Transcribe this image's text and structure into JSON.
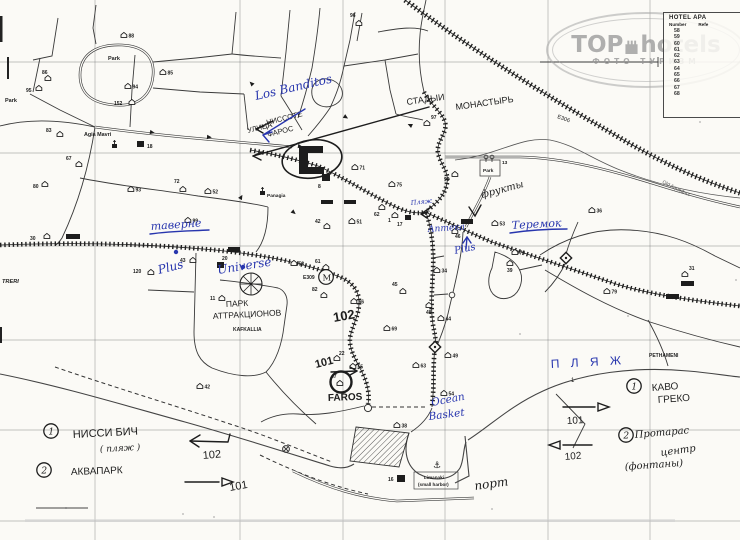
{
  "colors": {
    "paper": "#fbfaf6",
    "ink": "#1d1d1d",
    "print": "#3a3a3a",
    "blue": "#2836ae",
    "grid": "#6f6f6f",
    "gray_label": "#555555",
    "watermark": "#9a9a9a"
  },
  "watermark": {
    "brand_left": "TOP",
    "brand_right": "hotels",
    "subtitle": "ФОТО ТУРИЗМ"
  },
  "hotel_table": {
    "title": "HOTEL APA",
    "col_number": "Number",
    "col_ref": "Refe",
    "numbers": [
      "58",
      "59",
      "60",
      "61",
      "62",
      "63",
      "64",
      "65",
      "66",
      "67",
      "68"
    ]
  },
  "map": {
    "grid": {
      "vx": [
        95,
        240,
        343,
        445,
        548,
        650
      ],
      "hy": [
        62,
        153,
        246,
        340,
        430,
        521
      ]
    },
    "printed_labels": [
      {
        "t": "Park",
        "x": 108,
        "y": 60,
        "s": 5.5,
        "b": 1
      },
      {
        "t": "Park",
        "x": 5,
        "y": 102,
        "s": 5.5,
        "b": 1
      },
      {
        "t": "Park",
        "x": 483,
        "y": 172,
        "s": 4.8,
        "b": 1
      },
      {
        "t": "13",
        "x": 502,
        "y": 164,
        "s": 4.8,
        "b": 1
      },
      {
        "t": "Agia Mavri",
        "x": 84,
        "y": 136,
        "s": 5.4,
        "b": 1
      },
      {
        "t": "Panagia",
        "x": 267,
        "y": 197,
        "s": 4.8,
        "b": 1
      },
      {
        "t": "E306",
        "x": 557,
        "y": 118,
        "s": 5.6,
        "r": 20
      },
      {
        "t": "E309",
        "x": 303,
        "y": 279,
        "s": 5,
        "b": 1
      },
      {
        "t": "KAFKALLIA",
        "x": 233,
        "y": 331,
        "s": 5,
        "b": 1
      },
      {
        "t": "PETHAMENI",
        "x": 649,
        "y": 357,
        "s": 5,
        "b": 1
      },
      {
        "t": "Limanaki",
        "x": 424,
        "y": 479,
        "s": 4.6,
        "b": 1
      },
      {
        "t": "(small harbor)",
        "x": 418,
        "y": 486,
        "s": 4.6,
        "b": 1
      },
      {
        "t": "TRERI",
        "x": 2,
        "y": 283,
        "s": 5.6,
        "i": 1,
        "b": 1
      },
      {
        "t": "Old Aqueduct",
        "x": 662,
        "y": 183,
        "s": 5,
        "r": 26
      }
    ],
    "hotel_markers": [
      {
        "n": "96",
        "x": 356,
        "y": 21,
        "lx": 350,
        "ly": 17
      },
      {
        "n": "88",
        "x": 121,
        "y": 33
      },
      {
        "n": "85",
        "x": 160,
        "y": 70
      },
      {
        "n": "94",
        "x": 125,
        "y": 84
      },
      {
        "n": "86",
        "x": 45,
        "y": 76,
        "lx": 42,
        "ly": 74
      },
      {
        "n": "95",
        "x": 36,
        "y": 86,
        "lx": 26,
        "ly": 92
      },
      {
        "n": "152",
        "x": 129,
        "y": 100,
        "lx": 114,
        "ly": 105
      },
      {
        "n": "83",
        "x": 57,
        "y": 132,
        "lx": 46,
        "ly": 132
      },
      {
        "n": "67",
        "x": 76,
        "y": 162,
        "lx": 66,
        "ly": 160
      },
      {
        "n": "80",
        "x": 42,
        "y": 182,
        "lx": 33,
        "ly": 188
      },
      {
        "n": "93",
        "x": 128,
        "y": 187
      },
      {
        "n": "72",
        "x": 180,
        "y": 187,
        "lx": 174,
        "ly": 183
      },
      {
        "n": "52",
        "x": 205,
        "y": 189
      },
      {
        "n": "97",
        "x": 424,
        "y": 121,
        "lx": 431,
        "ly": 119
      },
      {
        "n": "71",
        "x": 352,
        "y": 165
      },
      {
        "n": "75",
        "x": 389,
        "y": 182
      },
      {
        "n": "62",
        "x": 379,
        "y": 205,
        "lx": 374,
        "ly": 216
      },
      {
        "n": "42",
        "x": 324,
        "y": 224,
        "lx": 315,
        "ly": 223
      },
      {
        "n": "51",
        "x": 349,
        "y": 219
      },
      {
        "n": "1",
        "x": 392,
        "y": 213,
        "lx": 388,
        "ly": 222
      },
      {
        "n": "90",
        "x": 452,
        "y": 172,
        "lx": 444,
        "ly": 181
      },
      {
        "n": "36",
        "x": 589,
        "y": 208
      },
      {
        "n": "53",
        "x": 492,
        "y": 221
      },
      {
        "n": "70",
        "x": 512,
        "y": 250
      },
      {
        "n": "39",
        "x": 507,
        "y": 261,
        "lx": 507,
        "ly": 272
      },
      {
        "n": "34",
        "x": 434,
        "y": 268
      },
      {
        "n": "46",
        "x": 452,
        "y": 229,
        "lx": 455,
        "ly": 238
      },
      {
        "n": "99",
        "x": 185,
        "y": 218
      },
      {
        "n": "43",
        "x": 190,
        "y": 258,
        "lx": 180,
        "ly": 262
      },
      {
        "n": "120",
        "x": 148,
        "y": 270,
        "lx": 133,
        "ly": 273
      },
      {
        "n": "58",
        "x": 291,
        "y": 261
      },
      {
        "n": "11",
        "x": 219,
        "y": 296,
        "lx": 210,
        "ly": 300
      },
      {
        "n": "61",
        "x": 323,
        "y": 265,
        "lx": 315,
        "ly": 263
      },
      {
        "n": "82",
        "x": 321,
        "y": 293,
        "lx": 312,
        "ly": 291
      },
      {
        "n": "66",
        "x": 351,
        "y": 299
      },
      {
        "n": "45",
        "x": 400,
        "y": 289,
        "lx": 392,
        "ly": 286
      },
      {
        "n": "48",
        "x": 426,
        "y": 303,
        "lx": 426,
        "ly": 314
      },
      {
        "n": "44",
        "x": 438,
        "y": 316
      },
      {
        "n": "69",
        "x": 384,
        "y": 326
      },
      {
        "n": "49",
        "x": 445,
        "y": 353
      },
      {
        "n": "63",
        "x": 413,
        "y": 363
      },
      {
        "n": "22",
        "x": 334,
        "y": 356,
        "lx": 339,
        "ly": 355
      },
      {
        "n": "55",
        "x": 350,
        "y": 364
      },
      {
        "n": "54",
        "x": 441,
        "y": 391
      },
      {
        "n": "38",
        "x": 394,
        "y": 423
      },
      {
        "n": "31",
        "x": 682,
        "y": 272,
        "lx": 689,
        "ly": 270
      },
      {
        "n": "79",
        "x": 604,
        "y": 289
      },
      {
        "n": "30",
        "x": 44,
        "y": 234,
        "lx": 30,
        "ly": 240
      },
      {
        "n": "42",
        "x": 197,
        "y": 384
      },
      {
        "n": "47",
        "x": 337,
        "y": 381,
        "lx": 331,
        "ly": 378
      }
    ],
    "black_squares": [
      {
        "x": 137,
        "y": 141,
        "w": 7,
        "h": 6,
        "n": "18",
        "lx": 147,
        "ly": 148
      },
      {
        "x": 322,
        "y": 174,
        "w": 8,
        "h": 7,
        "n": "8",
        "lx": 318,
        "ly": 188
      },
      {
        "x": 217,
        "y": 262,
        "w": 7,
        "h": 6,
        "n": "20",
        "lx": 222,
        "ly": 260
      },
      {
        "x": 397,
        "y": 475,
        "w": 8,
        "h": 7,
        "n": "16",
        "lx": 388,
        "ly": 481
      },
      {
        "x": 405,
        "y": 215,
        "w": 6,
        "h": 5,
        "n": "17",
        "lx": 397,
        "ly": 226
      },
      {
        "x": 461,
        "y": 219,
        "w": 12,
        "h": 5
      },
      {
        "x": 228,
        "y": 247,
        "w": 12,
        "h": 5
      },
      {
        "x": 66,
        "y": 234,
        "w": 14,
        "h": 5
      },
      {
        "x": 681,
        "y": 281,
        "w": 13,
        "h": 5
      },
      {
        "x": 666,
        "y": 294,
        "w": 13,
        "h": 5
      },
      {
        "x": 321,
        "y": 200,
        "w": 12,
        "h": 4
      },
      {
        "x": 344,
        "y": 200,
        "w": 12,
        "h": 4
      }
    ],
    "churches": [
      [
        112,
        144
      ],
      [
        260,
        191
      ]
    ],
    "trees": [
      [
        486,
        159
      ],
      [
        492,
        159
      ]
    ],
    "road_arrows": [
      [
        150,
        132,
        10
      ],
      [
        207,
        137,
        5
      ],
      [
        253,
        85,
        225
      ],
      [
        344,
        116,
        32
      ],
      [
        240,
        199,
        300
      ],
      [
        292,
        211,
        40
      ],
      [
        298,
        146,
        10
      ],
      [
        412,
        126,
        205
      ]
    ],
    "annotations": [
      {
        "t": "УЛИЦА",
        "x": 248,
        "y": 133,
        "s": 7.5,
        "r": -14,
        "c": "k",
        "f": "print"
      },
      {
        "t": "НИССОТЕ",
        "x": 267,
        "y": 125,
        "s": 7.5,
        "r": -14,
        "c": "k",
        "f": "print"
      },
      {
        "t": "ФАРОС",
        "x": 268,
        "y": 137,
        "s": 7.5,
        "r": -14,
        "c": "k",
        "f": "print"
      },
      {
        "t": "СТАДЫИ",
        "x": 407,
        "y": 105,
        "s": 9,
        "r": -8,
        "c": "k",
        "f": "print"
      },
      {
        "t": "МОНАСТЫРЬ",
        "x": 456,
        "y": 110,
        "s": 9,
        "r": -8,
        "c": "k",
        "f": "print"
      },
      {
        "t": "фрукты",
        "x": 482,
        "y": 198,
        "s": 10,
        "r": -15,
        "c": "k",
        "f": "script"
      },
      {
        "t": "ПАРК",
        "x": 226,
        "y": 307,
        "s": 8.5,
        "r": -3,
        "c": "k",
        "f": "print"
      },
      {
        "t": "АТТРАКЦИОНОВ",
        "x": 213,
        "y": 319,
        "s": 8.5,
        "r": -3,
        "c": "k",
        "f": "print"
      },
      {
        "t": "102",
        "x": 334,
        "y": 322,
        "s": 13,
        "r": -10,
        "c": "k",
        "f": "print",
        "b": 1
      },
      {
        "t": "101",
        "x": 316,
        "y": 368,
        "s": 11,
        "r": -14,
        "c": "k",
        "f": "print",
        "b": 1
      },
      {
        "t": "FAROS",
        "x": 328,
        "y": 401,
        "s": 10,
        "r": -2,
        "c": "k",
        "f": "print",
        "b": 1
      },
      {
        "t": "порт",
        "x": 475,
        "y": 490,
        "s": 12,
        "r": -8,
        "c": "k",
        "f": "script"
      },
      {
        "t": "1",
        "x": 571,
        "y": 382,
        "s": 6,
        "r": 0,
        "c": "k",
        "f": "print"
      },
      {
        "t": "НИССИ БИЧ",
        "x": 73,
        "y": 438,
        "s": 11,
        "r": -3,
        "c": "k",
        "f": "print"
      },
      {
        "t": "( пляж )",
        "x": 100,
        "y": 452,
        "s": 9,
        "r": -3,
        "c": "k",
        "f": "script"
      },
      {
        "t": "АКВАПАРК",
        "x": 71,
        "y": 475,
        "s": 10,
        "r": -2,
        "c": "k",
        "f": "print"
      },
      {
        "t": "102",
        "x": 203,
        "y": 459,
        "s": 11,
        "r": -5,
        "c": "k",
        "f": "print"
      },
      {
        "t": "101",
        "x": 230,
        "y": 491,
        "s": 11,
        "r": -10,
        "c": "k",
        "f": "print"
      },
      {
        "t": "КАВО",
        "x": 652,
        "y": 391,
        "s": 10,
        "r": -4,
        "c": "k",
        "f": "print"
      },
      {
        "t": "ГРЕКО",
        "x": 658,
        "y": 403,
        "s": 10,
        "r": -4,
        "c": "k",
        "f": "print"
      },
      {
        "t": "Протарас",
        "x": 635,
        "y": 438,
        "s": 10,
        "r": -5,
        "c": "k",
        "f": "script"
      },
      {
        "t": "центр",
        "x": 661,
        "y": 456,
        "s": 10,
        "r": -8,
        "c": "k",
        "f": "script"
      },
      {
        "t": "(фонтаны)",
        "x": 625,
        "y": 470,
        "s": 10,
        "r": -4,
        "c": "k",
        "f": "script"
      },
      {
        "t": "101",
        "x": 567,
        "y": 424,
        "s": 10,
        "r": -3,
        "c": "k",
        "f": "print"
      },
      {
        "t": "102",
        "x": 565,
        "y": 460,
        "s": 10,
        "r": -5,
        "c": "k",
        "f": "print"
      },
      {
        "t": "Los Banditos",
        "x": 256,
        "y": 100,
        "s": 12,
        "r": -13,
        "c": "b",
        "f": "script"
      },
      {
        "t": "таверне",
        "x": 151,
        "y": 230,
        "s": 11,
        "r": -4,
        "c": "b",
        "f": "script"
      },
      {
        "t": "Plus",
        "x": 159,
        "y": 274,
        "s": 12,
        "r": -14,
        "c": "b",
        "f": "script"
      },
      {
        "t": "Universe",
        "x": 218,
        "y": 274,
        "s": 12,
        "r": -9,
        "c": "b",
        "f": "script"
      },
      {
        "t": "Пляж",
        "x": 411,
        "y": 205,
        "s": 6.5,
        "r": -6,
        "c": "b",
        "f": "script"
      },
      {
        "t": "Аптека",
        "x": 428,
        "y": 232,
        "s": 9,
        "r": -4,
        "c": "b",
        "f": "script"
      },
      {
        "t": "Plus",
        "x": 455,
        "y": 254,
        "s": 10,
        "r": -12,
        "c": "b",
        "f": "script"
      },
      {
        "t": "Теремок",
        "x": 512,
        "y": 229,
        "s": 11,
        "r": -3,
        "c": "b",
        "f": "script"
      },
      {
        "t": "Ocean",
        "x": 432,
        "y": 406,
        "s": 10.5,
        "r": -11,
        "c": "b",
        "f": "script"
      },
      {
        "t": "Basket",
        "x": 429,
        "y": 420,
        "s": 10.5,
        "r": -7,
        "c": "b",
        "f": "script"
      },
      {
        "t": "П Л Я Ж",
        "x": 551,
        "y": 368,
        "s": 12,
        "r": -3,
        "c": "b",
        "f": "print",
        "sp": 4
      }
    ],
    "circled_numbers": [
      {
        "n": "1",
        "x": 51,
        "y": 431
      },
      {
        "n": "2",
        "x": 44,
        "y": 470
      },
      {
        "n": "1",
        "x": 634,
        "y": 386
      },
      {
        "n": "2",
        "x": 626,
        "y": 435
      }
    ],
    "strokes": [
      {
        "d": "M305,109 L263,135",
        "c": "b"
      },
      {
        "d": "M263,135 L272,132 M263,135 L269,142",
        "c": "b"
      },
      {
        "d": "M150,234 C170,231 190,231 209,230",
        "c": "b"
      },
      {
        "d": "M510,233 C530,230 548,229 567,229",
        "c": "b"
      },
      {
        "d": "M466,249 L467,237",
        "c": "b"
      },
      {
        "d": "M467,237 L463,243 M467,237 L471,243",
        "c": "b"
      },
      {
        "d": "M273,121 L256,129",
        "c": "k"
      },
      {
        "d": "M256,129 L264,126 M256,129 L263,133",
        "c": "k"
      },
      {
        "d": "M429,107 L253,156",
        "c": "k"
      },
      {
        "d": "M253,156 L262,152 M253,156 L261,160",
        "c": "k"
      },
      {
        "d": "M469,207 L475,216 L481,205",
        "c": "k"
      },
      {
        "d": "M431,207 L421,214",
        "c": "k"
      },
      {
        "d": "M421,214 L428,212 M421,214 L427,218",
        "c": "k"
      },
      {
        "d": "M331,372 L357,371",
        "c": "k"
      },
      {
        "d": "M357,371 L350,367 M357,371 L350,375",
        "c": "k"
      },
      {
        "d": "M228,442 L190,441 M228,442 L230,434",
        "c": "k"
      },
      {
        "d": "M190,441 L200,435 M190,441 L199,447",
        "c": "k"
      },
      {
        "d": "M185,482 L219,482",
        "c": "k"
      },
      {
        "d": "M222,478 L233,482 L222,486 Z",
        "c": "k"
      },
      {
        "d": "M563,407 L595,407",
        "c": "k"
      },
      {
        "d": "M598,403 L609,407 L598,411 Z",
        "c": "k"
      },
      {
        "d": "M592,445 L563,445",
        "c": "k"
      },
      {
        "d": "M560,441 L549,445 L560,449 Z",
        "c": "k"
      }
    ],
    "blue_dots": [
      [
        176,
        252
      ],
      [
        243,
        267
      ]
    ],
    "symbols": {
      "anchor": "⚓",
      "monument_letter": "M"
    }
  }
}
